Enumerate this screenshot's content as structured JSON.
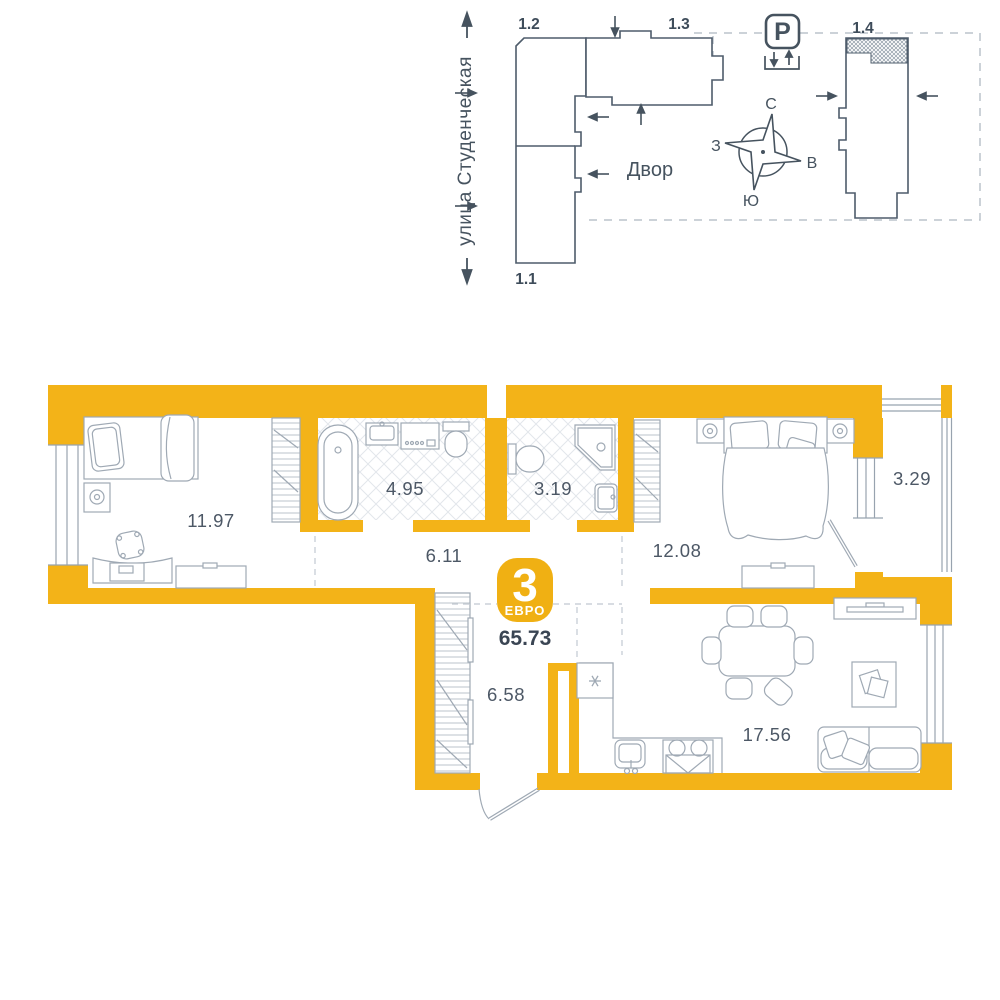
{
  "site_plan": {
    "street_label": "улица Студенческая",
    "courtyard_label": "Двор",
    "parking_label": "P",
    "buildings": [
      {
        "label": "1.2"
      },
      {
        "label": "1.3"
      },
      {
        "label": "1.1"
      },
      {
        "label": "1.4"
      }
    ],
    "compass": {
      "north": "С",
      "south": "Ю",
      "west": "З",
      "east": "В"
    }
  },
  "apartment": {
    "badge": {
      "rooms_count": "3",
      "layout_type": "ЕВРО",
      "total_area": "65.73"
    },
    "rooms": [
      {
        "name": "bedroom-1",
        "area": "11.97"
      },
      {
        "name": "bathroom",
        "area": "4.95"
      },
      {
        "name": "toilet",
        "area": "3.19"
      },
      {
        "name": "corridor",
        "area": "6.11"
      },
      {
        "name": "bedroom-2",
        "area": "12.08"
      },
      {
        "name": "balcony",
        "area": "3.29"
      },
      {
        "name": "hallway",
        "area": "6.58"
      },
      {
        "name": "kitchen-living-room",
        "area": "17.56"
      }
    ]
  },
  "colors": {
    "accent_yellow": "#F3B318",
    "plan_line": "#4E5C6B",
    "furniture_line": "#9FA9B4",
    "text_dark": "#3A4553"
  }
}
